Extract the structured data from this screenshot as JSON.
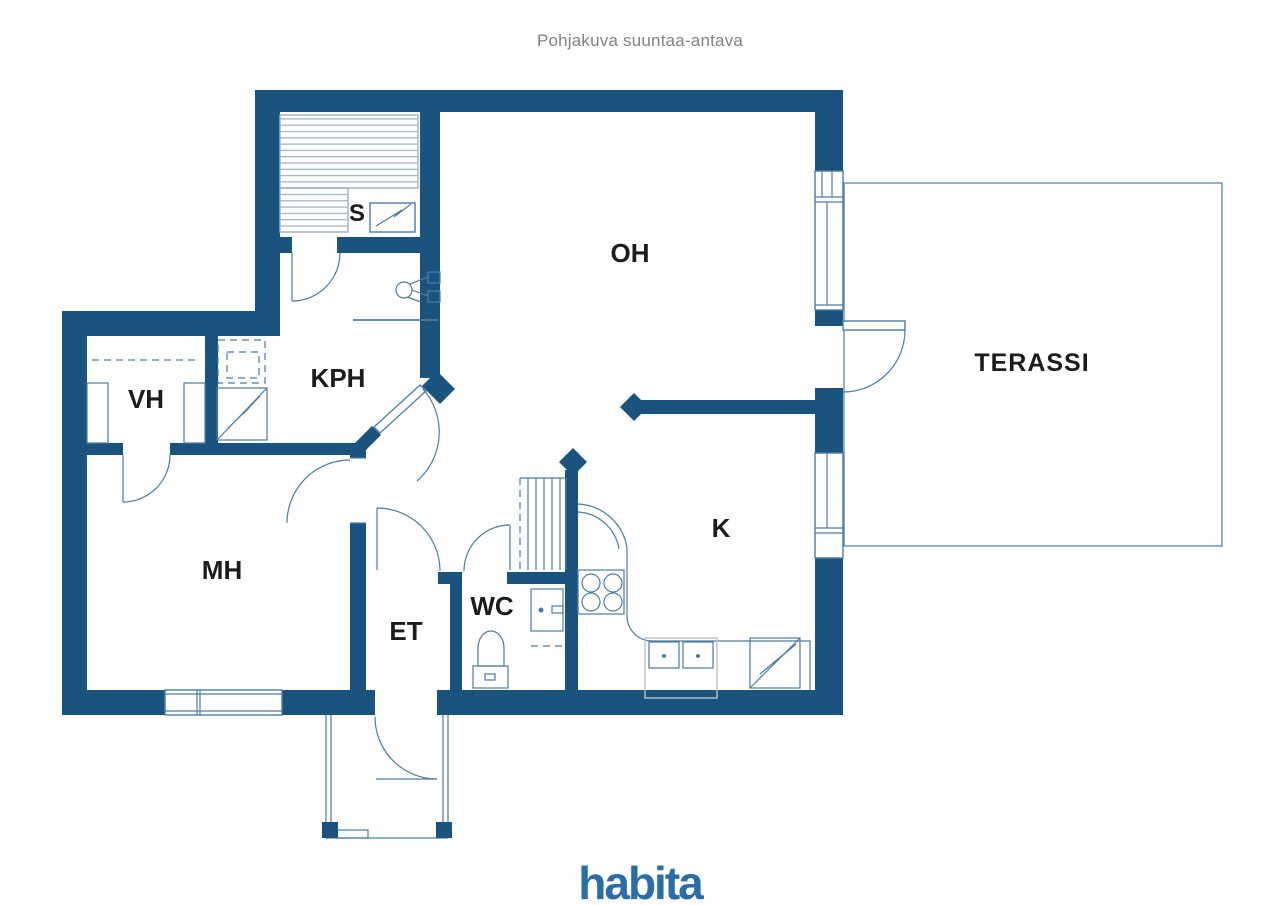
{
  "title": "Pohjakuva suuntaa-antava",
  "brand": {
    "logo_text": "habita"
  },
  "colors": {
    "wall": "#1a537e",
    "line": "#4d7ca4",
    "slat": "#9db1c2",
    "light": "#b9c3cc",
    "label": "#1c1c1c",
    "title_gray": "#808285",
    "logo": "#2b6da8"
  },
  "rooms": {
    "sauna": {
      "label": "S"
    },
    "living": {
      "label": "OH"
    },
    "bathroom": {
      "label": "KPH"
    },
    "closet": {
      "label": "VH"
    },
    "bedroom": {
      "label": "MH"
    },
    "entrance": {
      "label": "ET"
    },
    "wc": {
      "label": "WC"
    },
    "kitchen": {
      "label": "K"
    },
    "terrace": {
      "label": "TERASSI"
    }
  }
}
